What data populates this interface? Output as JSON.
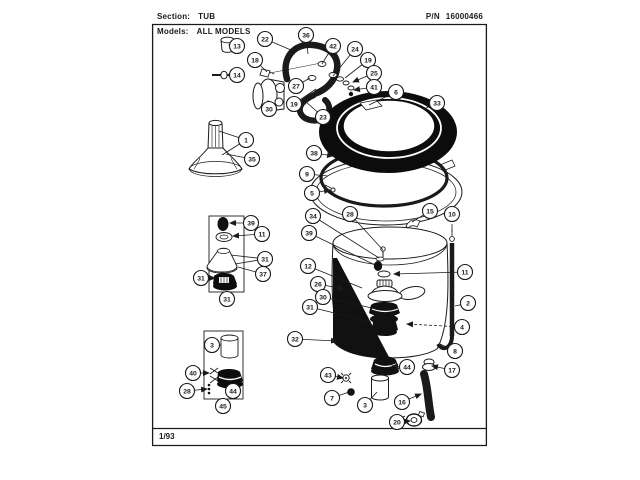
{
  "header": {
    "section_label": "Section:",
    "section_value": "TUB",
    "pn_label": "P/N",
    "pn_value": "16000466",
    "models_label": "Models:",
    "models_value": "ALL MODELS"
  },
  "footer": {
    "date_code": "1/93"
  },
  "colors": {
    "ink": "#1a1a1a",
    "paper": "#ffffff"
  },
  "diagram": {
    "title": "Tub assembly exploded parts view",
    "callout_style": {
      "radius": 7.5,
      "stroke": "#1a1a1a",
      "fill": "#ffffff",
      "font_size": 6.8
    },
    "callouts": [
      {
        "n": "13",
        "x": 237,
        "y": 46,
        "t": [
          [
            229,
            45
          ]
        ],
        "arrow": true
      },
      {
        "n": "14",
        "x": 237,
        "y": 75,
        "t": [
          [
            227,
            75
          ]
        ],
        "arrow": true
      },
      {
        "n": "1",
        "x": 246,
        "y": 140,
        "t": [
          [
            219,
            131
          ],
          [
            222,
            155
          ]
        ]
      },
      {
        "n": "35",
        "x": 252,
        "y": 159,
        "t": [
          [
            226,
            154
          ]
        ]
      },
      {
        "n": "22",
        "x": 265,
        "y": 39,
        "t": [
          [
            291,
            50
          ]
        ]
      },
      {
        "n": "36",
        "x": 306,
        "y": 35,
        "t": [
          [
            308,
            54
          ]
        ]
      },
      {
        "n": "42",
        "x": 333,
        "y": 46,
        "t": [
          [
            322,
            64
          ]
        ]
      },
      {
        "n": "24",
        "x": 355,
        "y": 49,
        "t": [
          [
            333,
            76
          ]
        ]
      },
      {
        "n": "19",
        "x": 368,
        "y": 60,
        "t": [
          [
            345,
            78
          ]
        ]
      },
      {
        "n": "25",
        "x": 374,
        "y": 73,
        "t": [
          [
            353,
            82
          ]
        ],
        "arrow": true
      },
      {
        "n": "41",
        "x": 374,
        "y": 87,
        "t": [
          [
            354,
            90
          ]
        ],
        "arrow": true
      },
      {
        "n": "18",
        "x": 255,
        "y": 60,
        "t": [
          [
            267,
            72
          ]
        ]
      },
      {
        "n": "30",
        "x": 269,
        "y": 109,
        "t": [
          [
            268,
            100
          ]
        ]
      },
      {
        "n": "27",
        "x": 296,
        "y": 86,
        "t": [
          [
            310,
            78
          ]
        ]
      },
      {
        "n": "19",
        "x": 294,
        "y": 104,
        "t": [
          [
            316,
            89
          ]
        ]
      },
      {
        "n": "23",
        "x": 323,
        "y": 117,
        "t": [
          [
            305,
            101
          ]
        ]
      },
      {
        "n": "6",
        "x": 396,
        "y": 92,
        "t": [
          [
            369,
            105
          ]
        ]
      },
      {
        "n": "33",
        "x": 437,
        "y": 103,
        "t": [
          [
            424,
            109
          ]
        ]
      },
      {
        "n": "38",
        "x": 314,
        "y": 153,
        "t": [
          [
            333,
            156
          ]
        ],
        "arrow": true
      },
      {
        "n": "9",
        "x": 307,
        "y": 174,
        "t": [
          [
            328,
            176
          ]
        ]
      },
      {
        "n": "5",
        "x": 312,
        "y": 193,
        "t": [
          [
            330,
            190
          ]
        ],
        "arrow": true
      },
      {
        "n": "15",
        "x": 430,
        "y": 211,
        "t": [
          [
            412,
            222
          ]
        ]
      },
      {
        "n": "10",
        "x": 452,
        "y": 214,
        "t": [
          [
            452,
            235
          ]
        ],
        "dashed": true
      },
      {
        "n": "28",
        "x": 350,
        "y": 214,
        "t": [
          [
            383,
            250
          ]
        ]
      },
      {
        "n": "34",
        "x": 313,
        "y": 216,
        "t": [
          [
            379,
            258
          ]
        ]
      },
      {
        "n": "39",
        "x": 309,
        "y": 233,
        "t": [
          [
            375,
            265
          ]
        ]
      },
      {
        "n": "12",
        "x": 308,
        "y": 266,
        "t": [
          [
            362,
            288
          ]
        ]
      },
      {
        "n": "26",
        "x": 318,
        "y": 284,
        "t": [
          [
            344,
            289
          ]
        ],
        "arrow": true
      },
      {
        "n": "11",
        "x": 465,
        "y": 272,
        "t": [
          [
            394,
            274
          ]
        ],
        "arrow": true
      },
      {
        "n": "2",
        "x": 468,
        "y": 303,
        "t": [
          [
            455,
            306
          ]
        ]
      },
      {
        "n": "30",
        "x": 323,
        "y": 297,
        "t": [
          [
            372,
            308
          ]
        ]
      },
      {
        "n": "31",
        "x": 310,
        "y": 307,
        "t": [
          [
            371,
            322
          ]
        ]
      },
      {
        "n": "32",
        "x": 295,
        "y": 339,
        "t": [
          [
            337,
            341
          ]
        ],
        "arrow": true
      },
      {
        "n": "4",
        "x": 462,
        "y": 327,
        "t": [
          [
            407,
            324
          ]
        ],
        "arrow": true,
        "dashed": true
      },
      {
        "n": "8",
        "x": 455,
        "y": 351,
        "t": [
          [
            440,
            344
          ]
        ]
      },
      {
        "n": "17",
        "x": 452,
        "y": 370,
        "t": [
          [
            432,
            366
          ]
        ],
        "arrow": true
      },
      {
        "n": "44",
        "x": 407,
        "y": 367,
        "t": [
          [
            392,
            366
          ]
        ],
        "arrow": true
      },
      {
        "n": "43",
        "x": 328,
        "y": 375,
        "t": [
          [
            343,
            378
          ]
        ],
        "arrow": true
      },
      {
        "n": "7",
        "x": 332,
        "y": 398,
        "t": [
          [
            349,
            392
          ]
        ]
      },
      {
        "n": "3",
        "x": 365,
        "y": 405,
        "t": [
          [
            377,
            392
          ]
        ]
      },
      {
        "n": "16",
        "x": 402,
        "y": 402,
        "t": [
          [
            421,
            394
          ]
        ],
        "arrow": true
      },
      {
        "n": "20",
        "x": 397,
        "y": 422,
        "t": [
          [
            410,
            421
          ]
        ],
        "arrow": true
      },
      {
        "n": "3",
        "x": 212,
        "y": 345,
        "t": [
          [
            221,
            345
          ]
        ]
      },
      {
        "n": "40",
        "x": 193,
        "y": 373,
        "t": [
          [
            209,
            373
          ]
        ],
        "arrow": true
      },
      {
        "n": "28",
        "x": 187,
        "y": 391,
        "t": [
          [
            207,
            389
          ]
        ],
        "arrow": true
      },
      {
        "n": "44",
        "x": 233,
        "y": 391,
        "t": [
          [
            231,
            384
          ]
        ],
        "arrow": true
      },
      {
        "n": "45",
        "x": 223,
        "y": 406,
        "t": []
      },
      {
        "n": "39",
        "x": 251,
        "y": 223,
        "t": [
          [
            230,
            223
          ]
        ],
        "arrow": true
      },
      {
        "n": "11",
        "x": 262,
        "y": 234,
        "t": [
          [
            233,
            236
          ]
        ],
        "arrow": true
      },
      {
        "n": "31",
        "x": 265,
        "y": 259,
        "t": [
          [
            231,
            255
          ],
          [
            235,
            264
          ]
        ]
      },
      {
        "n": "37",
        "x": 263,
        "y": 274,
        "t": [
          [
            238,
            267
          ]
        ]
      },
      {
        "n": "31",
        "x": 201,
        "y": 278,
        "t": [
          [
            215,
            278
          ]
        ],
        "arrow": true
      },
      {
        "n": "31",
        "x": 227,
        "y": 299,
        "t": []
      }
    ]
  }
}
